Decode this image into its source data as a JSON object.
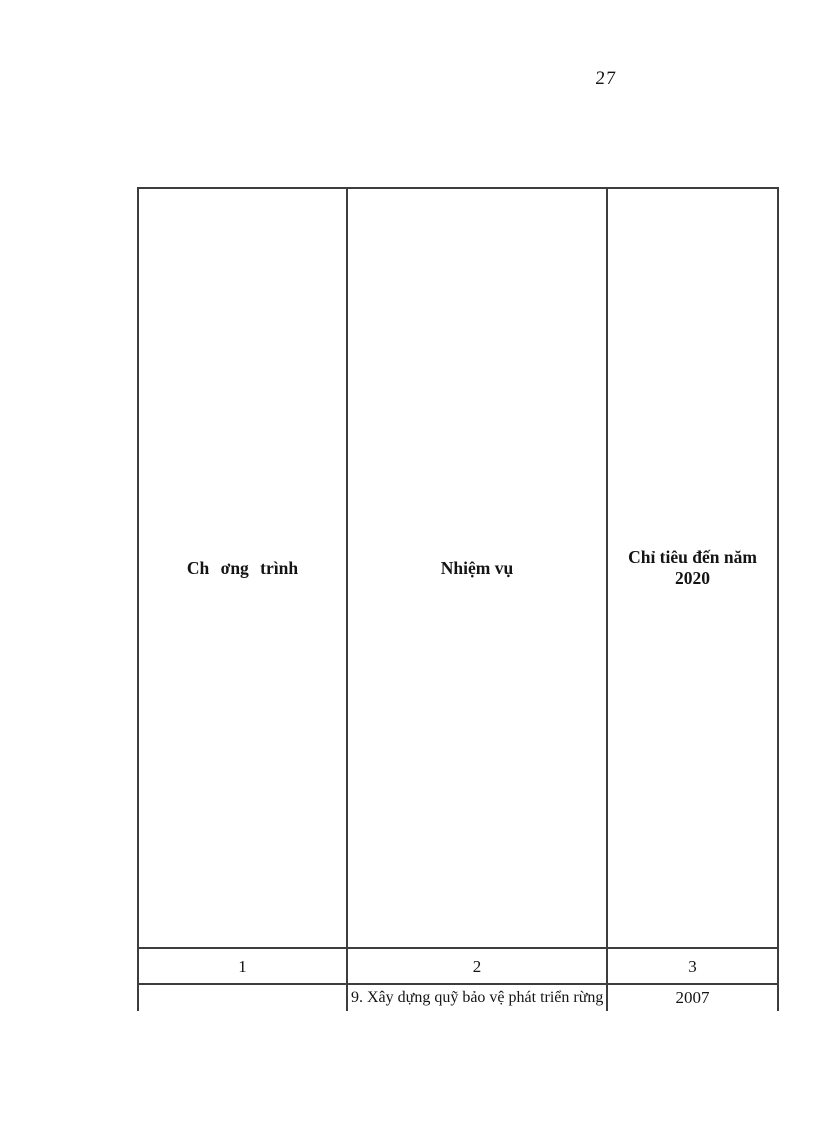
{
  "page": {
    "number": "27"
  },
  "table": {
    "headers": [
      "Ch ơng trình",
      "Nhiệm vụ",
      "Chỉ tiêu đến năm 2020"
    ],
    "column_numbers": [
      "1",
      "2",
      "3"
    ],
    "rows": [
      {
        "program": "",
        "task": "9. Xây dựng quỹ bảo vệ phát triển rừng",
        "target": "2007"
      }
    ]
  },
  "colors": {
    "border": "#3d3d3d",
    "text": "#141414",
    "background": "#ffffff"
  }
}
